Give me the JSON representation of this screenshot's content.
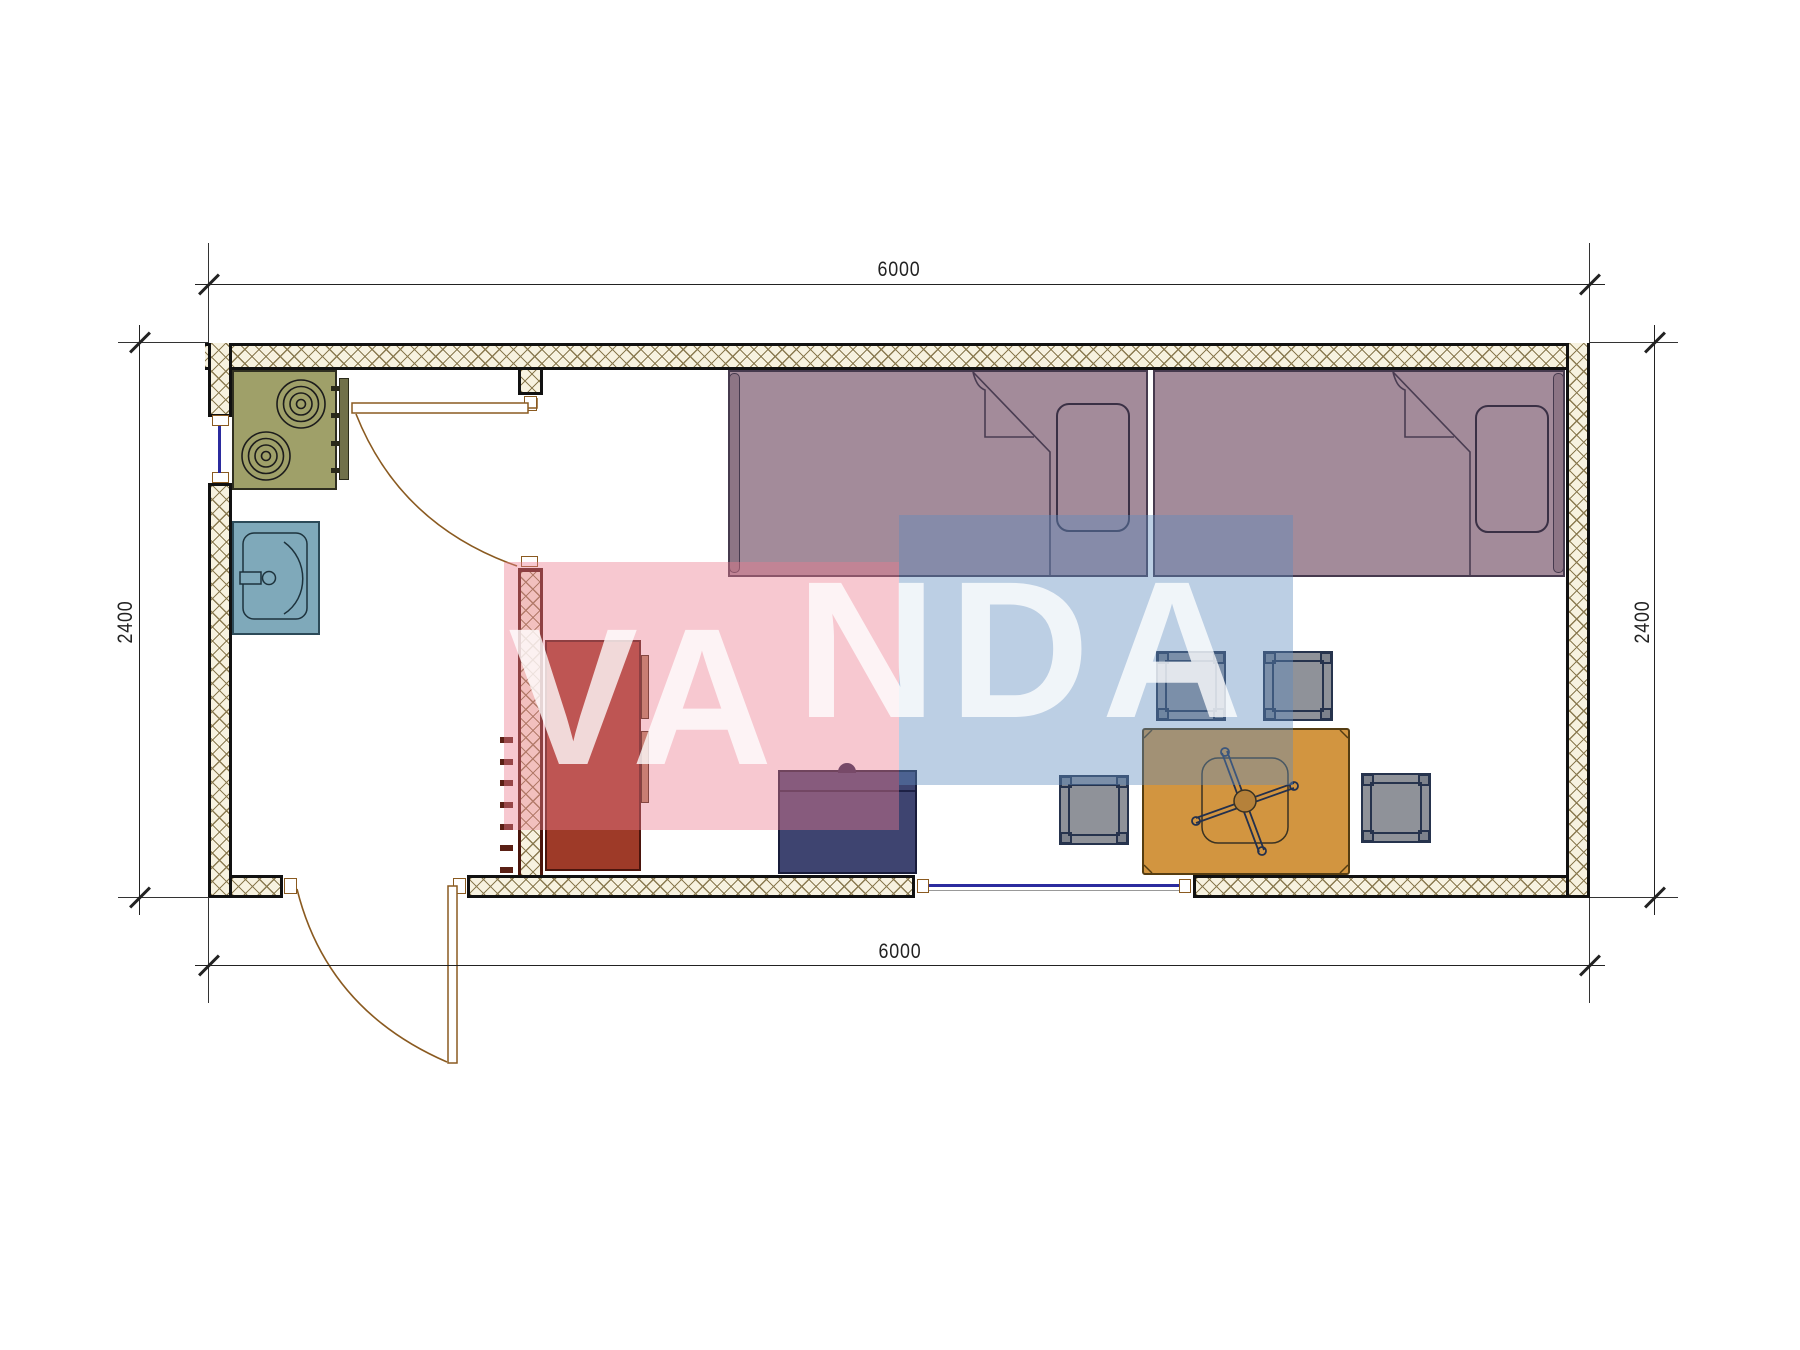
{
  "dimensions": {
    "top": {
      "label": "6000"
    },
    "bottom": {
      "label": "6000"
    },
    "left": {
      "label": "2400"
    },
    "right": {
      "label": "2400"
    }
  },
  "watermark": {
    "text": "VANDA",
    "segment_low": "VA",
    "segment_high": "NDA",
    "text_color": "#ffffff"
  },
  "plan": {
    "type": "floor-plan",
    "exterior_width_mm": 6000,
    "exterior_depth_mm": 2400,
    "rooms": [
      "entry-kitchen-nook",
      "living-sleeping-room"
    ],
    "furniture": [
      "cooktop-2-burners",
      "wash-basin",
      "single-bed-1",
      "single-bed-2",
      "wardrobe",
      "navy-cabinet",
      "dining-table-x-base",
      "stool-1",
      "stool-2",
      "stool-3",
      "stool-4"
    ],
    "openings": [
      "interior-door",
      "exterior-door",
      "window-left-wall",
      "window-bottom-wall"
    ]
  },
  "colors": {
    "wall_hatch_line": "#8a7a50",
    "wall_hatch_bg": "#f7f2e0",
    "wall_border": "#111111",
    "partition_border": "#4a150c",
    "stove": "#9fa069",
    "sink": "#7fa9ba",
    "bed": "#a38b9a",
    "bed_strip": "#8d7585",
    "wardrobe": "#9e3a28",
    "cabinet_navy": "#3e4470",
    "table": "#d29540",
    "stool": "#8f9299",
    "door_line": "#8a5a20",
    "window_line": "#2b2b9e",
    "dim_line": "#222222",
    "wm_pink": "#ec7c8e",
    "wm_blue": "#5f8cbe"
  }
}
